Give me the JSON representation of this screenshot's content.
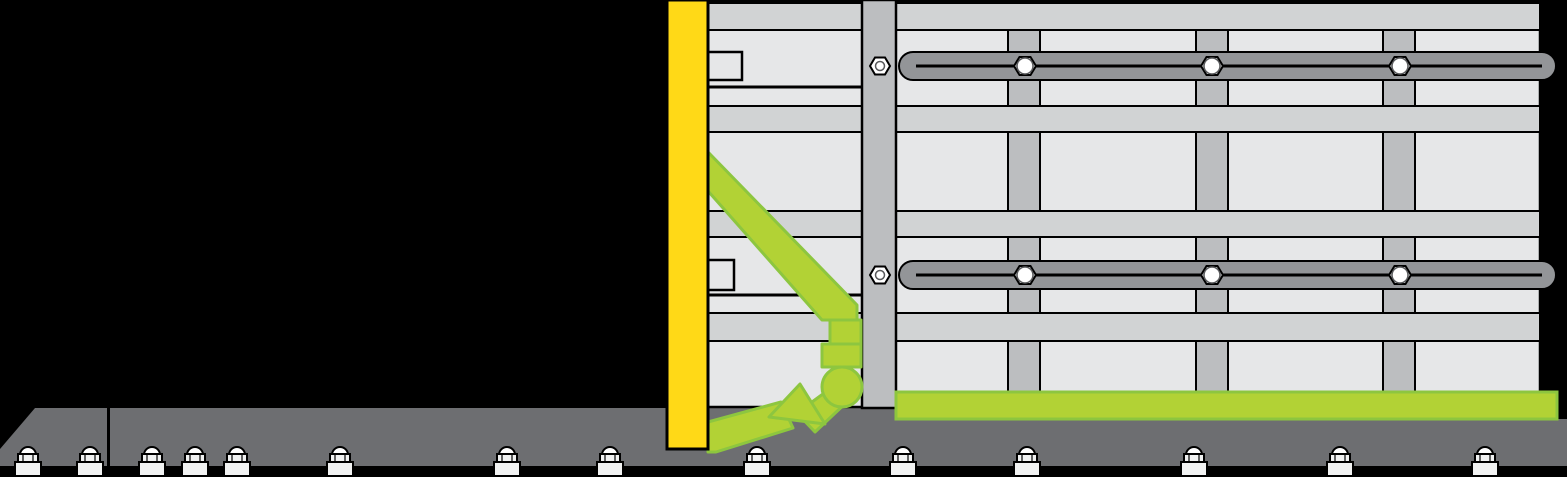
{
  "canvas": {
    "width": 1567,
    "height": 477
  },
  "colors": {
    "background": "#000000",
    "outline": "#000000",
    "panel_light": "#e6e7e8",
    "band_gray": "#d1d3d4",
    "stud_gray": "#bcbec0",
    "rail_gray": "#939598",
    "ground_gray": "#6d6e71",
    "lime_fill": "#b2d235",
    "lime_stroke": "#8dc63f",
    "yellow": "#ffd917",
    "white": "#ffffff",
    "fixture_light": "#f1f2f2",
    "detail_gray": "#58595b"
  },
  "ground": {
    "main_polygon": [
      [
        110,
        408
      ],
      [
        897,
        408
      ],
      [
        897,
        419
      ],
      [
        1567,
        419
      ],
      [
        1567,
        466
      ],
      [
        110,
        466
      ]
    ],
    "left_block_polygon": [
      [
        0,
        466
      ],
      [
        0,
        449
      ],
      [
        35,
        408
      ],
      [
        107,
        408
      ],
      [
        107,
        466
      ]
    ]
  },
  "anchors": {
    "centers_x": [
      28,
      90,
      152,
      195,
      237,
      340,
      507,
      610,
      757,
      903,
      1027,
      1194,
      1340,
      1485
    ]
  },
  "wall": {
    "x": 708,
    "y": 1,
    "width": 832,
    "height": 406,
    "bands_y": [
      [
        3,
        30
      ],
      [
        106,
        132
      ],
      [
        211,
        237
      ],
      [
        313,
        341
      ]
    ],
    "joint_lines_y": [
      87,
      295
    ],
    "left_section_right": 862
  },
  "studs": {
    "x_positions": [
      1008,
      1196,
      1383
    ],
    "width": 32,
    "rows_y": [
      [
        30,
        106
      ],
      [
        132,
        211
      ],
      [
        237,
        313
      ],
      [
        341,
        394
      ]
    ]
  },
  "tabs": [
    {
      "x": 708,
      "y": 52,
      "w": 34,
      "h": 28
    },
    {
      "x": 708,
      "y": 260,
      "w": 26,
      "h": 30
    }
  ],
  "post": {
    "x": 862,
    "y": 0,
    "width": 34,
    "height": 408
  },
  "rails": {
    "x": 899,
    "width": 657,
    "height": 28,
    "y_positions": [
      52,
      261
    ],
    "slot_x": [
      916,
      1542
    ]
  },
  "rail_bolts": {
    "x_positions": [
      1025,
      1212,
      1400
    ]
  },
  "post_bolts": {
    "x": 880
  },
  "sill": {
    "x": 896,
    "y": 392,
    "width": 661,
    "height": 27
  },
  "form_bar": {
    "x": 667,
    "y": 0,
    "width": 41,
    "height": 449
  },
  "brace": {
    "diagonal": [
      [
        708,
        152
      ],
      [
        708,
        191
      ],
      [
        822,
        320
      ],
      [
        857,
        320
      ],
      [
        857,
        305
      ]
    ],
    "segment_upper": {
      "x": 830,
      "y": 320,
      "w": 31,
      "h": 24
    },
    "segment_lower": {
      "x": 822,
      "y": 344,
      "w": 39,
      "h": 23
    },
    "arm_long": [
      [
        708,
        422
      ],
      [
        781,
        402
      ],
      [
        793,
        428
      ],
      [
        716,
        452
      ],
      [
        708,
        452
      ]
    ],
    "arm_small": [
      [
        827,
        391
      ],
      [
        849,
        400
      ],
      [
        815,
        432
      ],
      [
        797,
        413
      ]
    ],
    "wedge": [
      [
        800,
        384
      ],
      [
        769,
        417
      ],
      [
        825,
        424
      ]
    ],
    "ball": {
      "cx": 842,
      "cy": 387,
      "r": 20
    }
  }
}
